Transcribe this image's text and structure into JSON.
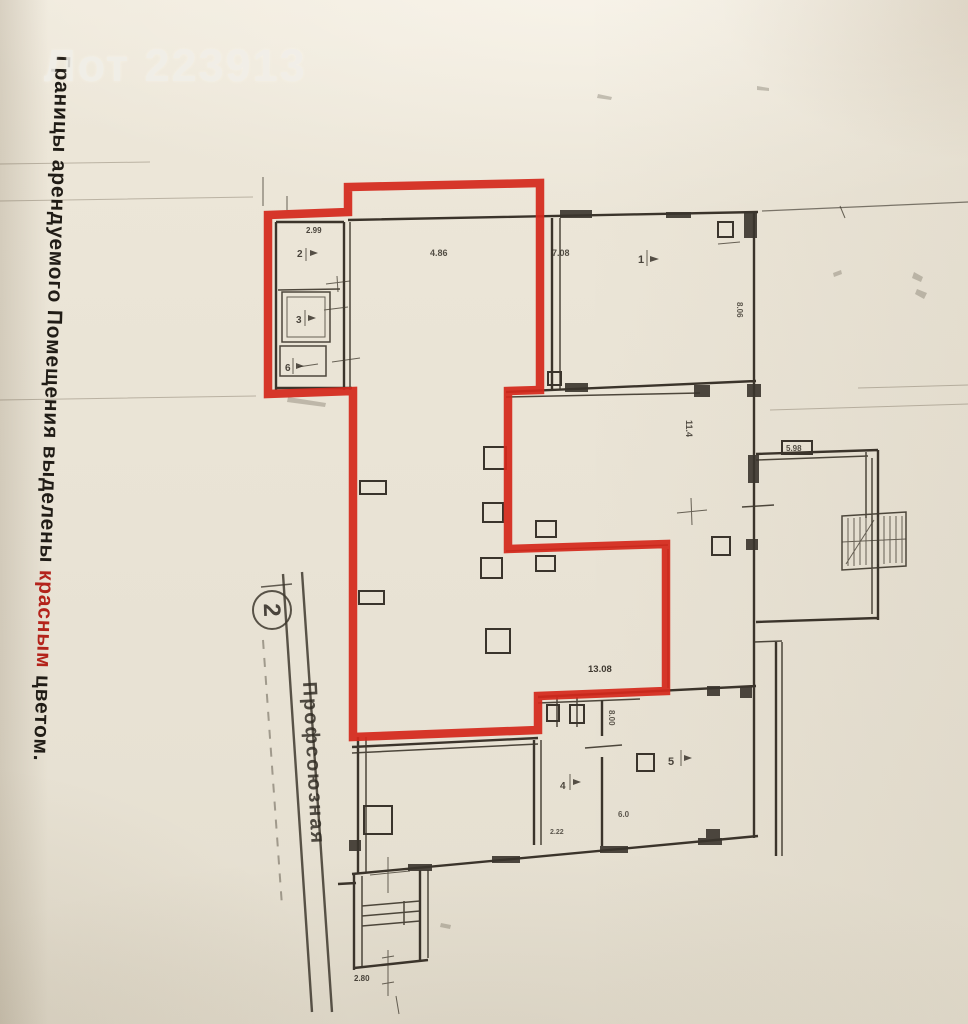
{
  "photo": {
    "lot_overlay": "Лот 223913",
    "caption": {
      "prefix": "Границы арендуемого Помещения выделены ",
      "highlight": "красным",
      "suffix": " цветом."
    },
    "street": {
      "marker": "2",
      "name": "Профсоюзная"
    },
    "colors": {
      "boundary": "#d4291c",
      "caption_highlight": "#b3231b",
      "lot_text": "#f1efe9"
    },
    "room_labels": {
      "annex_dim": "2.99",
      "annex_room2": "2",
      "annex_room3": "3",
      "annex_room6": "6",
      "hall_dim": "4.86",
      "top_right_dim": "7.08",
      "top_right_room": "1",
      "wall_dim_806": "8.06",
      "mid_dim_114": "11.4",
      "annex_right_dim": "5.98",
      "red_zone_dim": "13.08",
      "low_dim_800": "8.00",
      "low_room5": "5",
      "low_room4": "4",
      "low_dim_222": "2.22",
      "low_dim_60": "6.0",
      "porch_dim": "2.80"
    }
  }
}
